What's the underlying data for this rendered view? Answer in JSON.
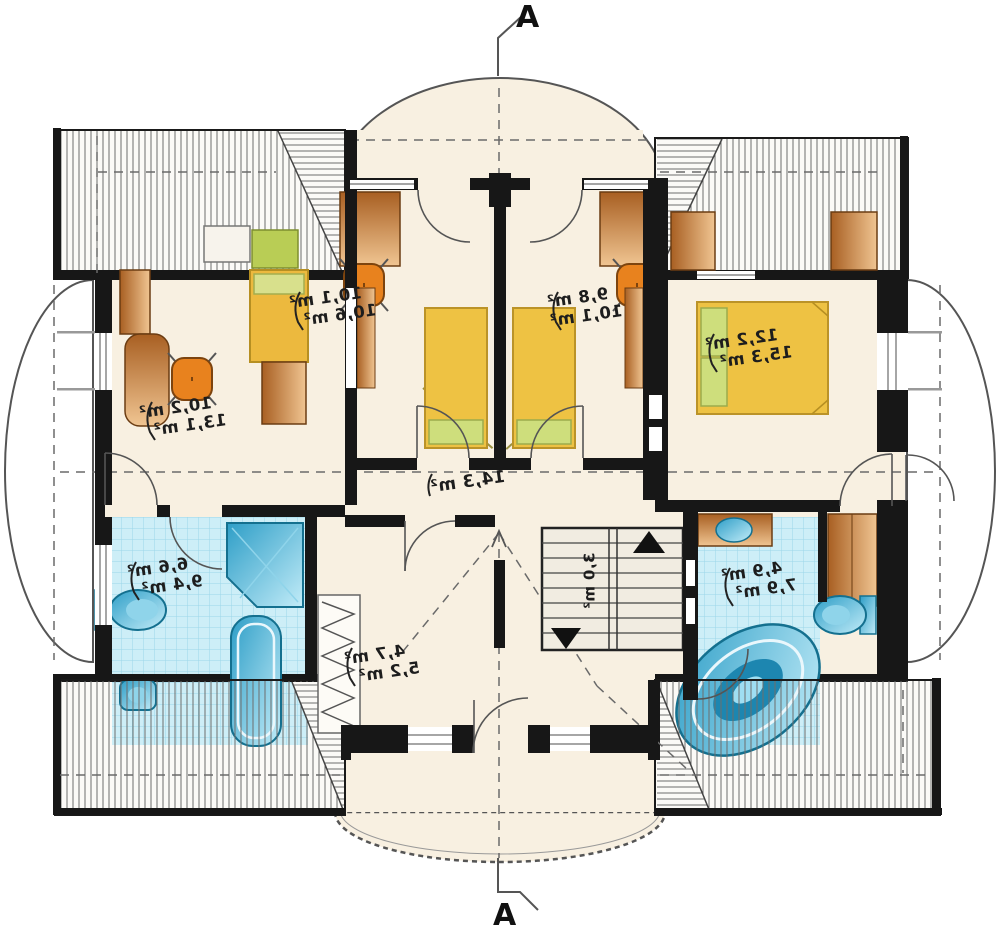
{
  "plan": {
    "section_label_top": "A",
    "section_label_bottom": "A",
    "rooms": {
      "top_left_room": {
        "area1": "10,2 m²",
        "area2": "13,1 m²"
      },
      "bedroom_left": {
        "area1": "10,1 m²",
        "area2": "10,6 m²"
      },
      "bedroom_right": {
        "area1": "9,8 m²",
        "area2": "10,1 m²"
      },
      "master_bedroom": {
        "area1": "12,2 m²",
        "area2": "15,3 m²"
      },
      "hallway": {
        "area1": "14,3 m²"
      },
      "bathroom_left": {
        "area1": "6,6 m²",
        "area2": "9,4 m²"
      },
      "wardrobe_room": {
        "area1": "4,7 m²",
        "area2": "5,2 m²"
      },
      "bathroom_right": {
        "area1": "4,9 m²",
        "area2": "7,9 m²"
      },
      "stairs": {
        "area1": "3,0 m²"
      }
    },
    "colors": {
      "floor": "#f8f0e1",
      "wall": "#171717",
      "tile": "#cdeef7",
      "fixture_blue": "#2e9ec7",
      "bed_yellow": "#eec243",
      "pillow_green": "#cede7c",
      "wood": "#b06a28",
      "chair_orange": "#e8821e",
      "shelf_green": "#b9cd55"
    }
  }
}
